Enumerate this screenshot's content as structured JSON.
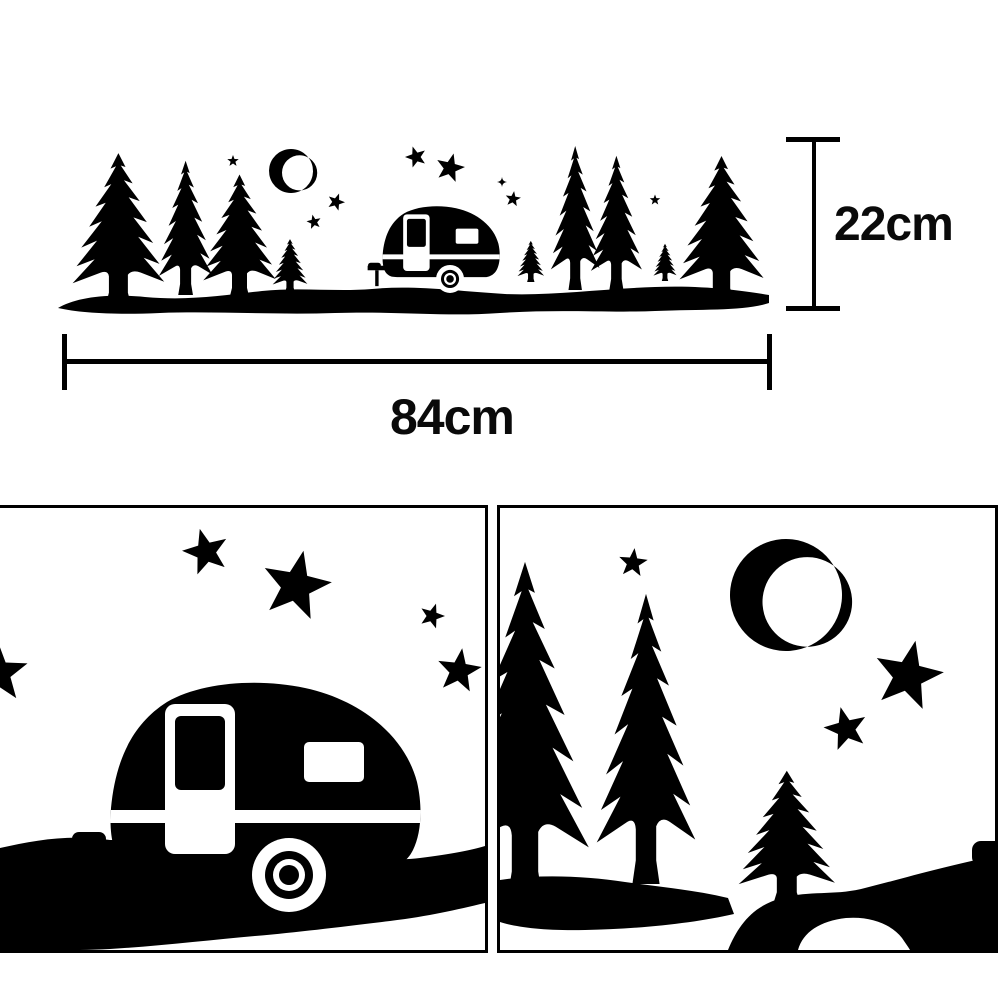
{
  "product_diagram": {
    "measurements": {
      "height": {
        "label": "22cm"
      },
      "width": {
        "label": "84cm"
      }
    },
    "colors": {
      "silhouette": "#000000",
      "background": "#ffffff",
      "panel_border": "#000000",
      "label_text": "#0a0a0a"
    },
    "icons": {
      "moon": "crescent-moon-icon",
      "star": "star-icon",
      "sparkle": "four-point-star-icon",
      "tree": "pine-tree-icon",
      "camper": "camper-trailer-icon",
      "ground": "ground-silhouette"
    }
  }
}
